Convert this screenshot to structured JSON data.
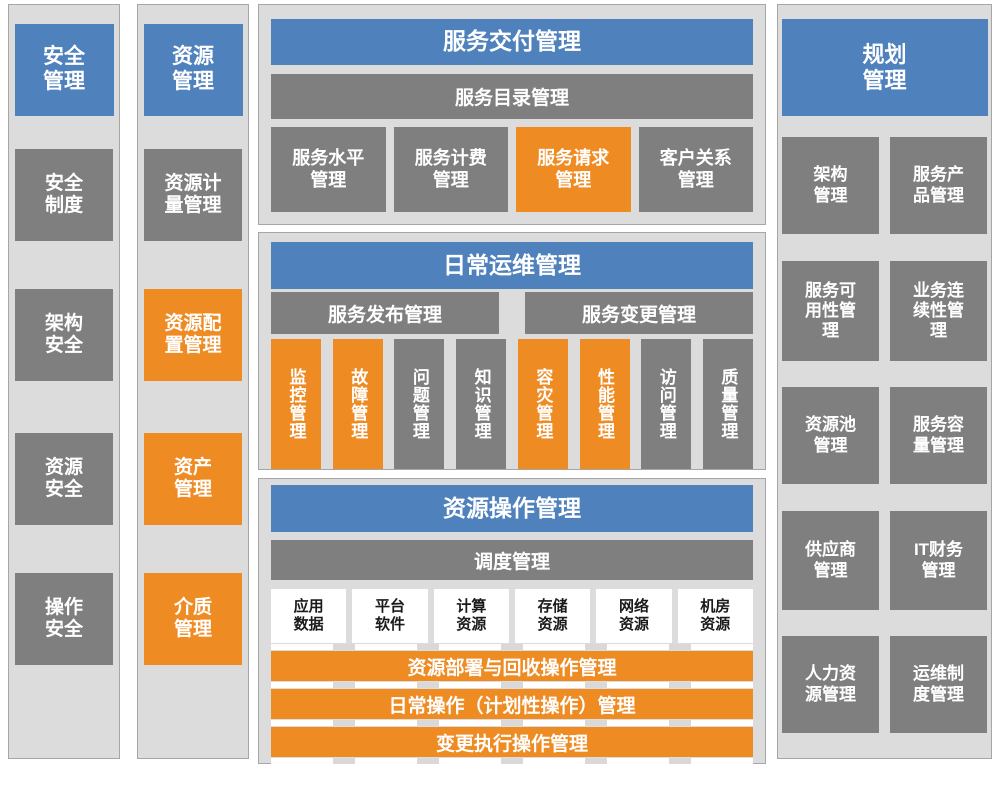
{
  "colors": {
    "blue": "#4F81BD",
    "orange": "#EF8B23",
    "gray": "#7F7F7F",
    "panel_bg": "#DCDCDC",
    "border": "#A6A6A6",
    "dash": "#D9D9D9"
  },
  "security_column": {
    "header": "安全\n管理",
    "items": [
      {
        "label": "安全\n制度",
        "color": "gray"
      },
      {
        "label": "架构\n安全",
        "color": "gray"
      },
      {
        "label": "资源\n安全",
        "color": "gray"
      },
      {
        "label": "操作\n安全",
        "color": "gray"
      }
    ]
  },
  "resource_column": {
    "header": "资源\n管理",
    "items": [
      {
        "label": "资源计\n量管理",
        "color": "gray"
      },
      {
        "label": "资源配\n置管理",
        "color": "orange"
      },
      {
        "label": "资产\n管理",
        "color": "orange"
      },
      {
        "label": "介质\n管理",
        "color": "orange"
      }
    ]
  },
  "service_delivery": {
    "title": "服务交付管理",
    "catalog_bar": "服务目录管理",
    "items": [
      {
        "label": "服务水平\n管理",
        "color": "gray"
      },
      {
        "label": "服务计费\n管理",
        "color": "gray"
      },
      {
        "label": "服务请求\n管理",
        "color": "orange"
      },
      {
        "label": "客户关系\n管理",
        "color": "gray"
      }
    ]
  },
  "daily_ops": {
    "title": "日常运维管理",
    "release_bar": "服务发布管理",
    "change_bar": "服务变更管理",
    "items": [
      {
        "label": "监控管理",
        "color": "orange"
      },
      {
        "label": "故障管理",
        "color": "orange"
      },
      {
        "label": "问题管理",
        "color": "gray"
      },
      {
        "label": "知识管理",
        "color": "gray"
      },
      {
        "label": "容灾管理",
        "color": "orange"
      },
      {
        "label": "性能管理",
        "color": "orange"
      },
      {
        "label": "访问管理",
        "color": "gray"
      },
      {
        "label": "质量管理",
        "color": "gray"
      }
    ]
  },
  "resource_ops": {
    "title": "资源操作管理",
    "schedule_bar": "调度管理",
    "resources": [
      {
        "label": "应用\n数据"
      },
      {
        "label": "平台\n软件"
      },
      {
        "label": "计算\n资源"
      },
      {
        "label": "存储\n资源"
      },
      {
        "label": "网络\n资源"
      },
      {
        "label": "机房\n资源"
      }
    ],
    "operation_bars": [
      {
        "label": "资源部署与回收操作管理"
      },
      {
        "label": "日常操作（计划性操作）管理"
      },
      {
        "label": "变更执行操作管理"
      }
    ]
  },
  "planning_column": {
    "header": "规划\n管理",
    "items": [
      {
        "label": "架构\n管理",
        "color": "gray"
      },
      {
        "label": "服务产\n品管理",
        "color": "gray"
      },
      {
        "label": "服务可\n用性管\n理",
        "color": "gray"
      },
      {
        "label": "业务连\n续性管\n理",
        "color": "gray"
      },
      {
        "label": "资源池\n管理",
        "color": "gray"
      },
      {
        "label": "服务容\n量管理",
        "color": "gray"
      },
      {
        "label": "供应商\n管理",
        "color": "gray"
      },
      {
        "label": "IT财务\n管理",
        "color": "gray"
      },
      {
        "label": "人力资\n源管理",
        "color": "gray"
      },
      {
        "label": "运维制\n度管理",
        "color": "gray"
      }
    ]
  }
}
